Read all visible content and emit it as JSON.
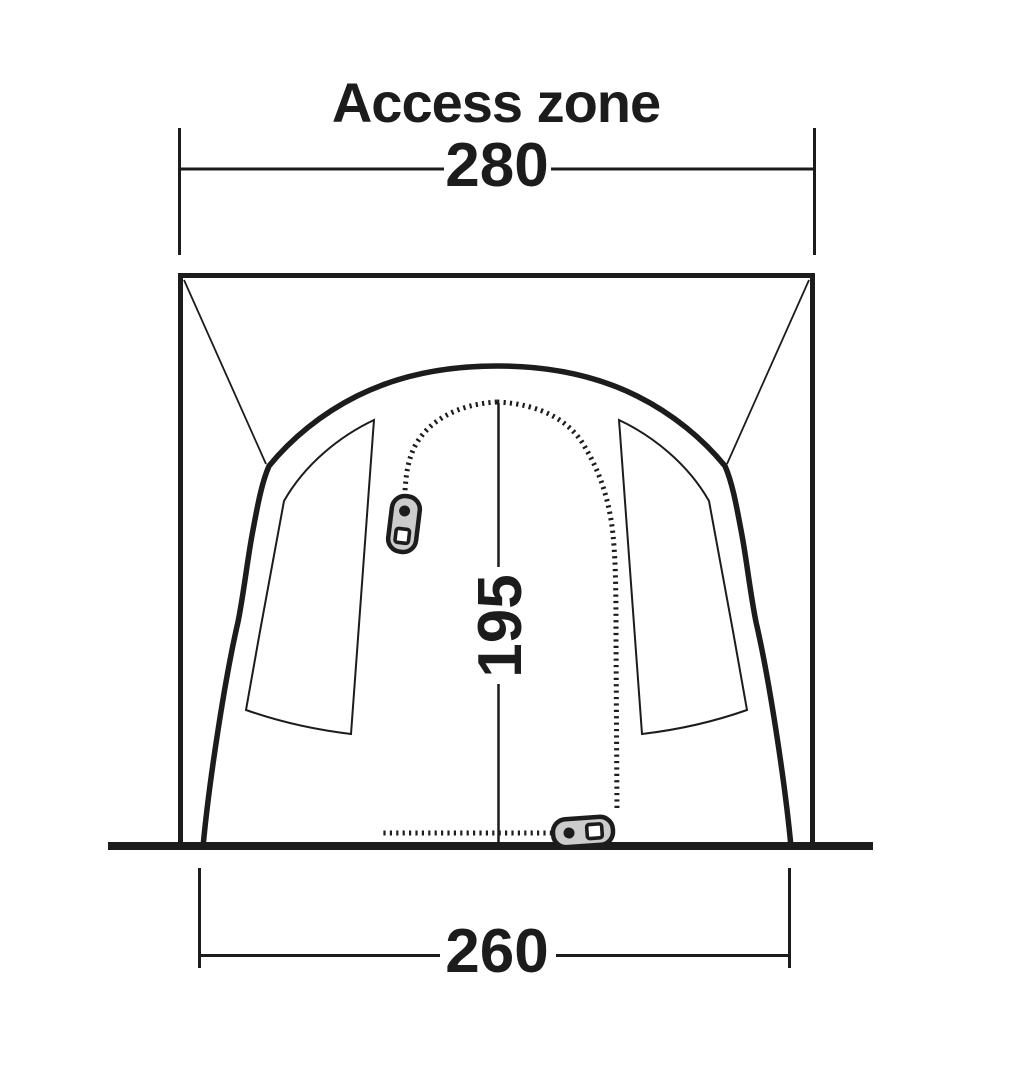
{
  "title": "Access zone",
  "dimensions": {
    "top_width": "280",
    "door_height": "195",
    "base_width": "260"
  },
  "colors": {
    "ink": "#1c1c1c",
    "zipper_pull_fill": "#cccccc",
    "background": "#ffffff"
  }
}
